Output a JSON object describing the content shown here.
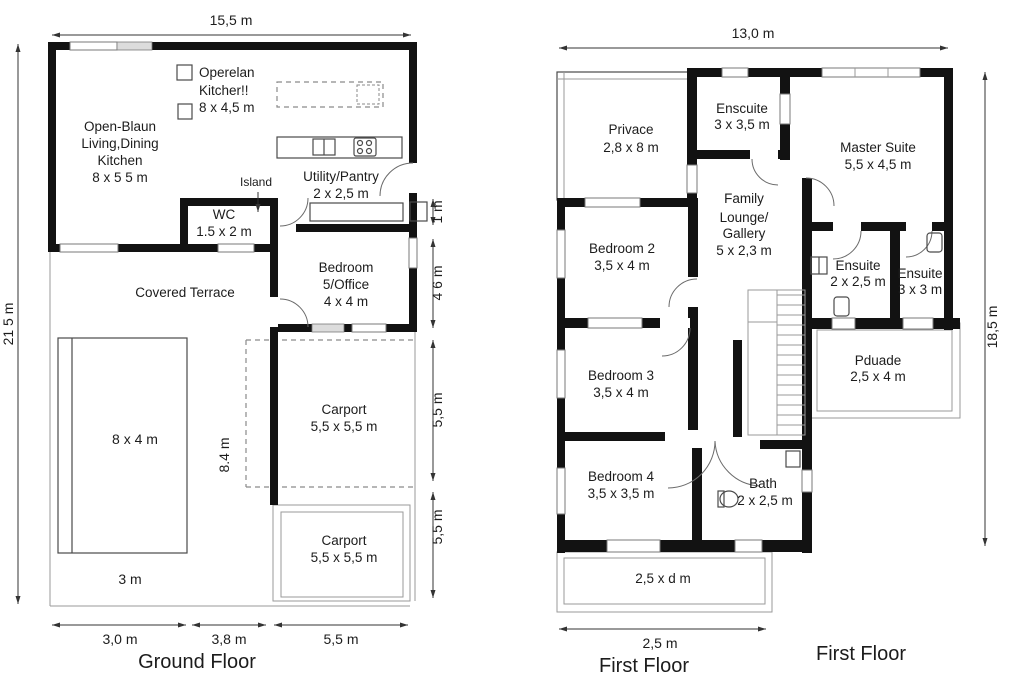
{
  "colors": {
    "wall": "#121212",
    "line": "#4a4a4a",
    "dash": "#8a8a8a",
    "text": "#1c1c1c",
    "pane": "#dcdcdc",
    "bg": "#ffffff"
  },
  "ground_floor": {
    "title": "Ground Floor",
    "dims": {
      "top": "15,5 m",
      "left": "21 5 m",
      "right_1": "1 m",
      "right_2": "4 6 m",
      "right_3": "5,5 m",
      "right_4": "5,5 m",
      "bottom_1": "3,0 m",
      "bottom_2": "3,8 m",
      "bottom_3": "5,5 m",
      "carport_depth": "8.4 m"
    },
    "rooms": {
      "open_plan": [
        "Open-Blaun",
        "Living,Dining",
        "Kitchen",
        "8 x 5 5 m"
      ],
      "kitchen_note": [
        "Operelan",
        "Kitcher!!",
        "8 x 4,5 m"
      ],
      "island": "Island",
      "utility": [
        "Utility/Pantry",
        "2 x 2,5 m"
      ],
      "wc": [
        "WC",
        "1.5 x 2 m"
      ],
      "bedroom5": [
        "Bedroom",
        "5/Office",
        "4 x 4 m"
      ],
      "terrace": "Covered Terrace",
      "carport_upper": [
        "Carport",
        "5,5 x 5,5 m"
      ],
      "carport_lower": [
        "Carport",
        "5,5 x 5,5 m"
      ],
      "pool": "8 x 4 m",
      "pool_margin": "3 m"
    }
  },
  "first_floor": {
    "title_left": "First Floor",
    "title_right": "First Floor",
    "dims": {
      "top": "13,0 m",
      "right": "18,5 m",
      "bottom": "2,5 m"
    },
    "rooms": {
      "privace": [
        "Privace",
        "2,8 x 8 m"
      ],
      "enscuite": [
        "Enscuite",
        "3 x 3,5 m"
      ],
      "master": [
        "Master Suite",
        "5,5 x 4,5 m"
      ],
      "family": [
        "Family",
        "Lounge/",
        "Gallery",
        "5 x 2,3 m"
      ],
      "bedroom2": [
        "Bedroom 2",
        "3,5 x 4 m"
      ],
      "ensuite_a": [
        "Ensuite",
        "2 x 2,5 m"
      ],
      "ensuite_b": [
        "Ensuite",
        "3 x 3 m"
      ],
      "bedroom3": [
        "Bedroom 3",
        "3,5 x 4 m"
      ],
      "pduade": [
        "Pduade",
        "2,5 x 4 m"
      ],
      "bedroom4": [
        "Bedroom 4",
        "3,5 x 3,5 m"
      ],
      "bath": [
        "Bath",
        "2 x 2,5 m"
      ],
      "balcony": "2,5 x d m"
    }
  }
}
